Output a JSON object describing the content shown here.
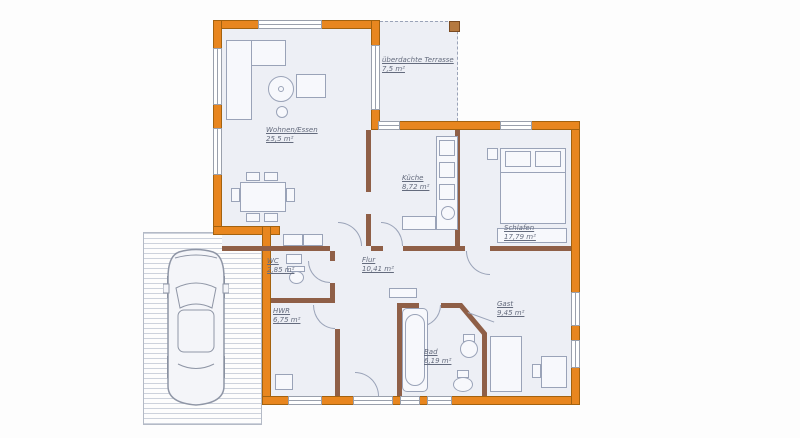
{
  "plan": {
    "type": "house-floor-plan",
    "colors": {
      "outer_wall": "#e8861f",
      "outer_wall_edge": "#a3620f",
      "interior_wall": "#8f5f47",
      "floor": "#edeff5",
      "furniture_outline": "#9aa3b8",
      "label_text": "#646b7d"
    },
    "rooms": {
      "wohnen": {
        "name": "Wohnen/Essen",
        "area": "25,5 m²"
      },
      "terrasse": {
        "name": "überdachte Terrasse",
        "area": "7,5 m²"
      },
      "kueche": {
        "name": "Küche",
        "area": "8,72 m²"
      },
      "schlafen": {
        "name": "Schlafen",
        "area": "17,79 m²"
      },
      "flur": {
        "name": "Flur",
        "area": "10,41 m²"
      },
      "wc": {
        "name": "WC",
        "area": "2,85 m²"
      },
      "hwr": {
        "name": "HWR",
        "area": "6,75 m²"
      },
      "bad": {
        "name": "Bad",
        "area": "6,19 m²"
      },
      "gast": {
        "name": "Gast",
        "area": "9,45 m²"
      }
    }
  }
}
